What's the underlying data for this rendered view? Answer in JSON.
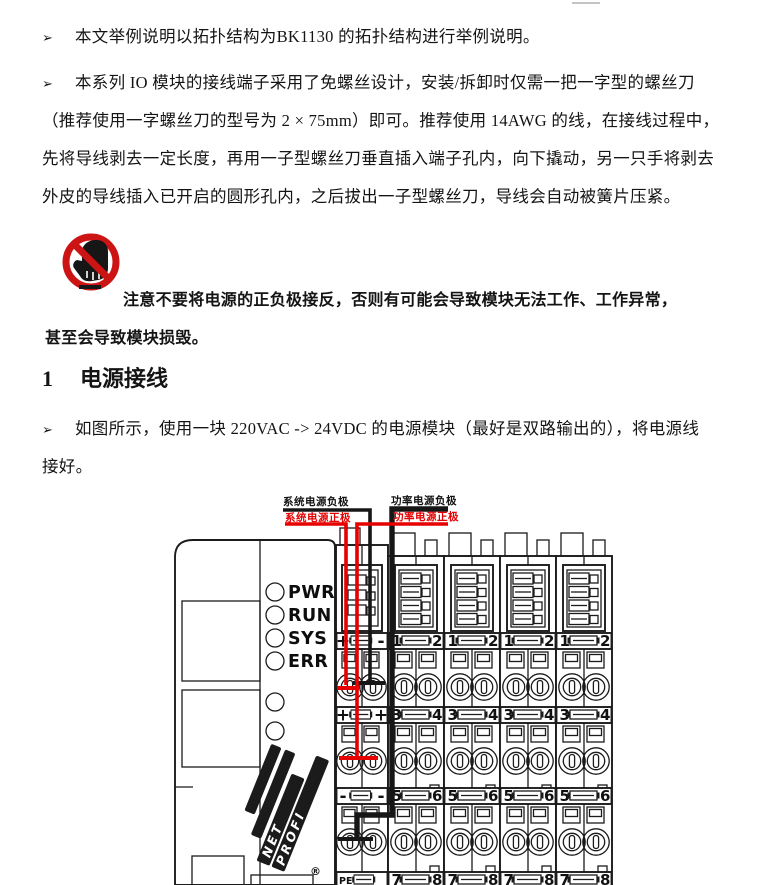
{
  "doc": {
    "marker": "➢",
    "para1": "本文举例说明以拓扑结构为BK1130 的拓扑结构进行举例说明。",
    "para2_lines": [
      "本系列 IO 模块的接线端子采用了免螺丝设计，安装/拆卸时仅需一把一字型的螺丝刀",
      "（推荐使用一字螺丝刀的型号为 2 × 75mm）即可。推荐使用 14AWG 的线，在接线过程中，",
      "先将导线剥去一定长度，再用一子型螺丝刀垂直插入端子孔内，向下撬动，另一只手将剥去",
      "外皮的导线插入已开启的圆形孔内，之后拔出一子型螺丝刀，导线会自动被簧片压紧。"
    ],
    "warning_lines": [
      "注意不要将电源的正负极接反，否则有可能会导致模块无法工作、工作异常，",
      "甚至会导致模块损毁。"
    ],
    "heading_num": "1",
    "heading_title": "电源接线",
    "para3_lines": [
      "如图所示，使用一块 220VAC -> 24VDC 的电源模块（最好是双路输出的），将电源线",
      "接好。"
    ]
  },
  "diagram": {
    "labels": {
      "sys_neg": "系统电源负极",
      "sys_pos": "系统电源正极",
      "pwr_neg": "功率电源负极",
      "pwr_pos": "功率电源正极"
    },
    "leds": [
      "PWR",
      "RUN",
      "SYS",
      "ERR"
    ],
    "logo": {
      "net": "NET",
      "profi": "PROFI",
      "reg": "®"
    },
    "power_rows": [
      {
        "l": "+",
        "r": "-"
      },
      {
        "l": "+",
        "r": "+"
      },
      {
        "l": "-",
        "r": "-"
      },
      {
        "l": "PE",
        "r": ""
      }
    ],
    "io_rows": [
      {
        "l": "1",
        "r": "2"
      },
      {
        "l": "3",
        "r": "4"
      },
      {
        "l": "5",
        "r": "6"
      },
      {
        "l": "7",
        "r": "8"
      }
    ],
    "colors": {
      "positive": "#e60000",
      "negative": "#161616",
      "warning": "#cc1414"
    }
  }
}
